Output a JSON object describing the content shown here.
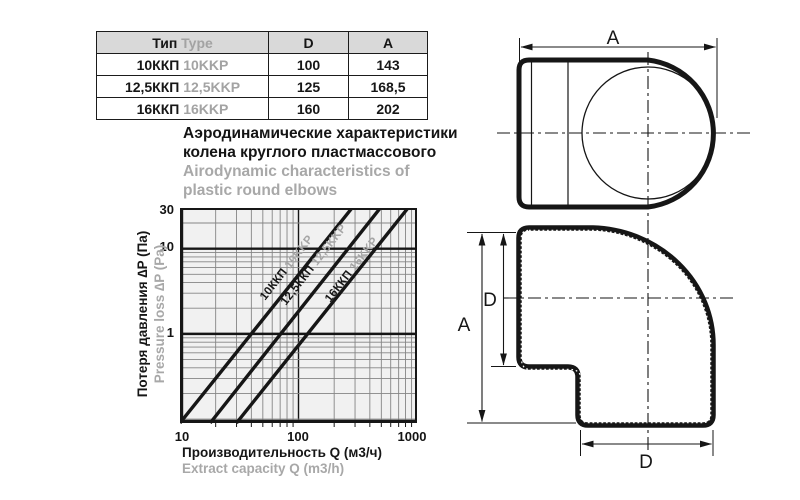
{
  "table": {
    "headers": {
      "type_ru": "Тип",
      "type_en": "Type",
      "d": "D",
      "a": "A"
    },
    "rows": [
      {
        "type_ru": "10ККП",
        "type_en": "10KKP",
        "d": "100",
        "a": "143"
      },
      {
        "type_ru": "12,5ККП",
        "type_en": "12,5KKP",
        "d": "125",
        "a": "168,5"
      },
      {
        "type_ru": "16ККП",
        "type_en": "16KKP",
        "d": "160",
        "a": "202"
      }
    ]
  },
  "title": {
    "ru_line1": "Аэродинамические характеристики",
    "ru_line2": "колена круглого пластмассового",
    "en_line1": "Airodynamic characteristics of",
    "en_line2": "plastic round elbows"
  },
  "chart_data": {
    "type": "line",
    "x_scale": "log",
    "y_scale": "log",
    "xlim": [
      10,
      1000
    ],
    "ylim": [
      0.09,
      30
    ],
    "x_ticks": [
      10,
      100,
      1000
    ],
    "x_tick_labels": [
      "10",
      "100",
      "1000"
    ],
    "y_ticks": [
      30,
      10,
      1
    ],
    "y_tick_labels": [
      "30",
      "10",
      "1"
    ],
    "xlabel_ru": "Производительность Q (м3/ч)",
    "xlabel_en": "Extract capacity Q (m3/h)",
    "ylabel_ru": "Потеря давления ∆P (Па)",
    "ylabel_en": "Pressure loss ∆P (Pa)",
    "grid": "log major + minor, on",
    "legend_position": "labels along lines",
    "series": [
      {
        "name_ru": "10ККП",
        "name_en": "10KKP",
        "points": [
          [
            10,
            0.09
          ],
          [
            283,
            30
          ]
        ]
      },
      {
        "name_ru": "12,5ККП",
        "name_en": "12,5KKP",
        "points": [
          [
            18,
            0.09
          ],
          [
            490,
            30
          ]
        ]
      },
      {
        "name_ru": "16ККП",
        "name_en": "16KKP",
        "points": [
          [
            30,
            0.09
          ],
          [
            840,
            30
          ]
        ]
      }
    ],
    "colors": {
      "ink": "#161616",
      "grid_minor": "#858585",
      "plot_bg": "#f1f1f1",
      "secondary_text": "#a8a8a8",
      "table_header_bg": "#d9d9d9"
    }
  },
  "drawings": {
    "top_view": {
      "dim_a": "A"
    },
    "side_view": {
      "dim_a": "A",
      "dim_d_left": "D",
      "dim_d_bottom": "D"
    }
  }
}
